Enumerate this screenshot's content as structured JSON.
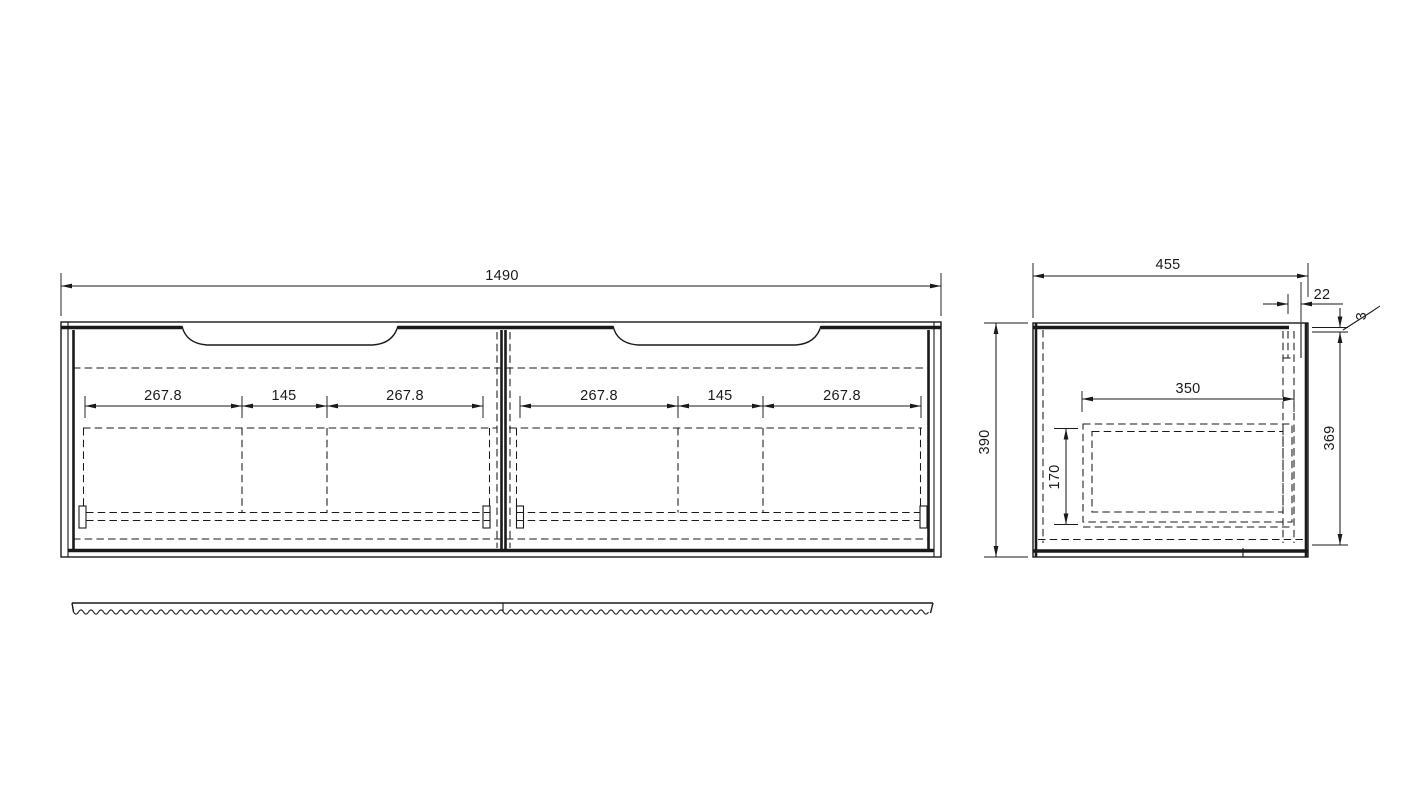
{
  "front_view": {
    "overall_width": "1490",
    "left_drawer": {
      "segments": [
        "267.8",
        "145",
        "267.8"
      ]
    },
    "right_drawer": {
      "segments": [
        "267.8",
        "145",
        "267.8"
      ]
    }
  },
  "side_view": {
    "overall_depth": "455",
    "front_panel_thickness": "22",
    "reveal_gap": "3",
    "overall_height": "390",
    "inner_height": "369",
    "drawer_box_depth": "350",
    "drawer_box_height": "170"
  },
  "colors": {
    "line": "#1a1a1a",
    "background": "#ffffff"
  }
}
